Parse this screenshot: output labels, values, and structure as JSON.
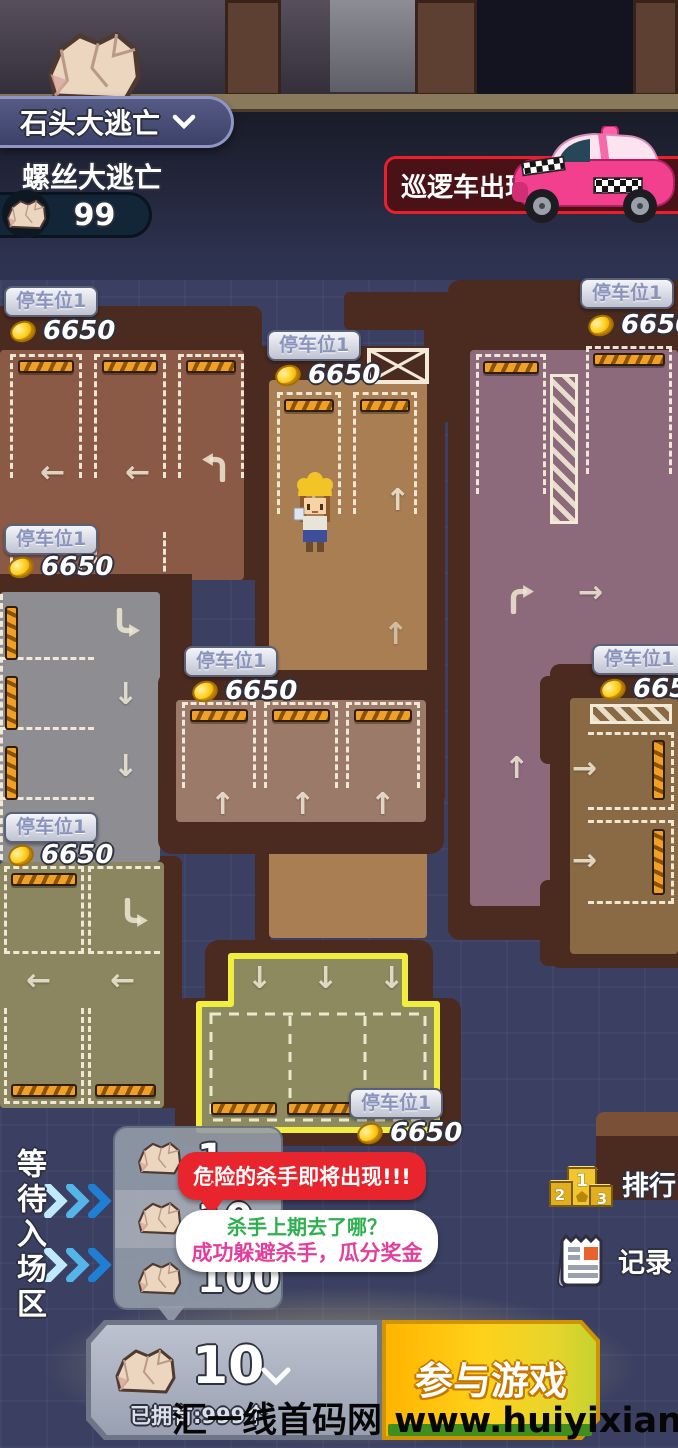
{
  "header": {
    "game_selector": "石头大逃亡",
    "subtitle": "螺丝大逃亡",
    "rock_count": "99"
  },
  "alert_banner": {
    "text": "巡逻车出现"
  },
  "lots": [
    {
      "label": "停车位1",
      "reward": "6650"
    },
    {
      "label": "停车位1",
      "reward": "6650"
    },
    {
      "label": "停车位1",
      "reward": "6650"
    },
    {
      "label": "停车位1",
      "reward": "6650"
    },
    {
      "label": "停车位1",
      "reward": "6650"
    },
    {
      "label": "停车位1",
      "reward": "6650"
    },
    {
      "label": "停车位1",
      "reward": "6650"
    },
    {
      "label": "停车位1",
      "reward": "6650"
    }
  ],
  "waiting_zone": {
    "label": "等待入场区"
  },
  "entry_tiers": {
    "amounts": [
      "1",
      "10",
      "100"
    ]
  },
  "bubbles": {
    "danger": "危险的杀手即将出现!!!",
    "question": "杀手上期去了哪？",
    "reward": "成功躲避杀手，瓜分奖金"
  },
  "side_menu": {
    "ranking": "排行",
    "record": "记录",
    "podium": [
      "1",
      "2",
      "3"
    ]
  },
  "footer": {
    "stake": "10",
    "owned": "已拥有:999个",
    "join": "参与游戏"
  },
  "watermark": "汇一线首码网 www.huiyixian.com",
  "colors": {
    "background": "#3b4062",
    "alert_red": "#e8252d",
    "join_yellow": "#ffc400",
    "highlight_yellow": "#f2ee3e",
    "coin_gold": "#ffd022",
    "chevron_blue": "#2f8fd6",
    "bubble_green_text": "#2eb050",
    "bubble_pink_text": "#e23f9a"
  }
}
